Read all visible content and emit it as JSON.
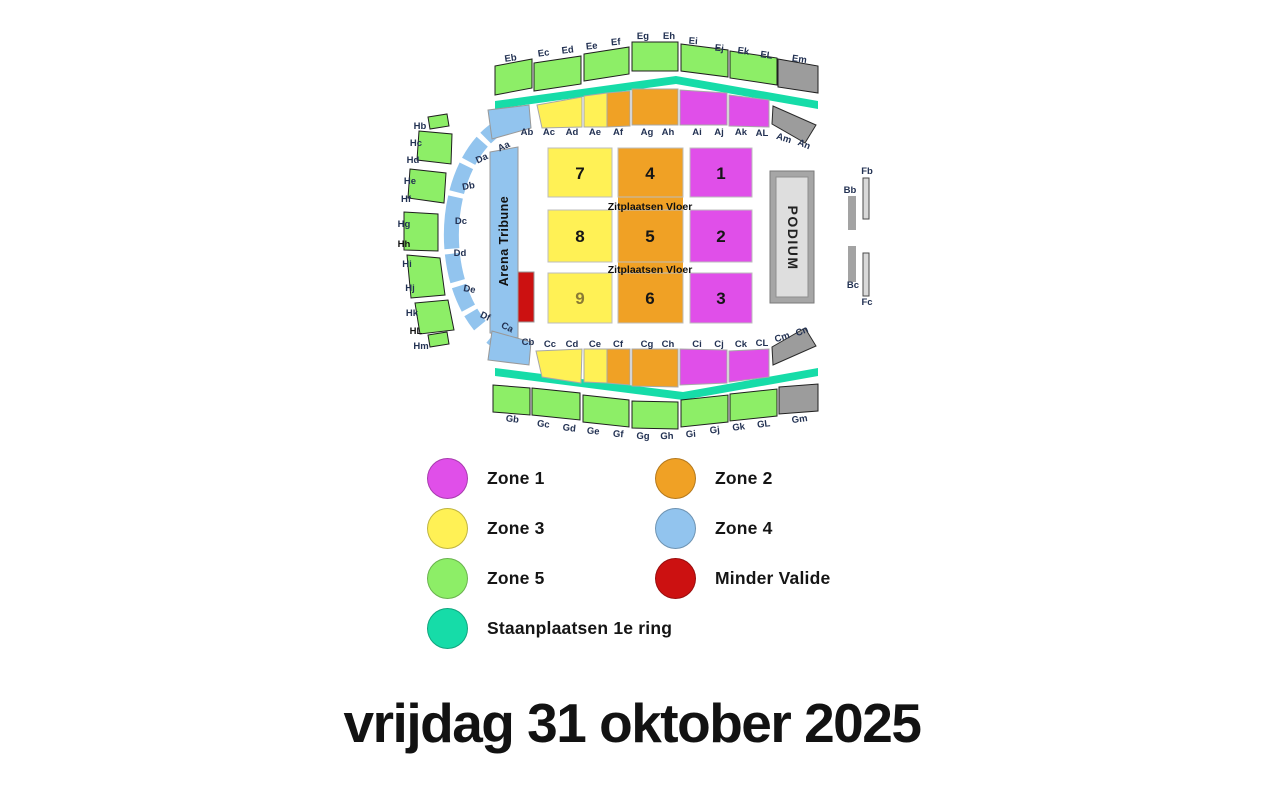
{
  "zones": {
    "zone1": "#E04FE9",
    "zone2": "#F0A125",
    "zone3": "#FFF155",
    "zone4": "#92C4EE",
    "zone5": "#8DEE67",
    "minder_valide": "#CC1111",
    "staanplaatsen": "#16DCA8",
    "gray": "#9C9C9C"
  },
  "map": {
    "label_color": "#233253",
    "shapes": [
      {
        "t": "poly",
        "n": "standing-ring-top",
        "z": "staanplaatsen",
        "i": true,
        "pts": "495,101 676,76 818,101 818,109 676,84 495,109"
      },
      {
        "t": "poly",
        "n": "standing-ring-bottom",
        "z": "staanplaatsen",
        "i": true,
        "pts": "495,368 683,392 818,368 818,376 683,400 495,376"
      },
      {
        "t": "path",
        "n": "ring-sections-arc",
        "z": "zone4",
        "i": true,
        "d": "M 498 128 A 76 116 0 0 0 498 342",
        "sw": 15,
        "da": "16 5 24 5 28 5 52 5 28 5 24 5 16"
      },
      {
        "t": "poly",
        "n": "section-arena-tribune",
        "z": "zone4",
        "st": "#999999",
        "i": true,
        "pts": "490,152 518,147 518,338 490,333"
      },
      {
        "t": "poly",
        "n": "section-ab",
        "z": "zone4",
        "st": "#999999",
        "i": true,
        "pts": "488,110 529,105 531,128 492,139"
      },
      {
        "t": "poly",
        "n": "section-cb",
        "z": "zone4",
        "st": "#999999",
        "i": true,
        "pts": "492,331 531,342 529,365 488,360"
      },
      {
        "t": "poly",
        "n": "section-eb",
        "z": "zone5",
        "st": "#1F1F1F",
        "i": true,
        "pts": "495,66 532,59 532,88 495,95"
      },
      {
        "t": "poly",
        "n": "section-ec-ed",
        "z": "zone5",
        "st": "#1F1F1F",
        "i": true,
        "pts": "534,63 581,56 581,84 534,91"
      },
      {
        "t": "poly",
        "n": "section-ee-ef",
        "z": "zone5",
        "st": "#1F1F1F",
        "i": true,
        "pts": "584,54 629,47 629,74 584,81"
      },
      {
        "t": "poly",
        "n": "section-eg-eh",
        "z": "zone5",
        "st": "#1F1F1F",
        "i": true,
        "pts": "632,42 678,42 678,71 632,71"
      },
      {
        "t": "poly",
        "n": "section-ei-ej",
        "z": "zone5",
        "st": "#1F1F1F",
        "i": true,
        "pts": "681,44 728,50 728,77 681,71"
      },
      {
        "t": "poly",
        "n": "section-ek-el",
        "z": "zone5",
        "st": "#1F1F1F",
        "i": true,
        "pts": "730,51 777,58 777,85 730,78"
      },
      {
        "t": "poly",
        "n": "section-em",
        "z": "gray",
        "st": "#1F1F1F",
        "i": true,
        "pts": "778,59 818,66 818,93 778,87"
      },
      {
        "t": "poly",
        "n": "section-gb",
        "z": "zone5",
        "st": "#1F1F1F",
        "i": true,
        "pts": "493,385 530,388 530,415 493,412"
      },
      {
        "t": "poly",
        "n": "section-gc-gd",
        "z": "zone5",
        "st": "#1F1F1F",
        "i": true,
        "pts": "532,388 580,393 580,420 532,415"
      },
      {
        "t": "poly",
        "n": "section-ge-gf",
        "z": "zone5",
        "st": "#1F1F1F",
        "i": true,
        "pts": "583,395 629,400 629,427 583,422"
      },
      {
        "t": "poly",
        "n": "section-gg-gh",
        "z": "zone5",
        "st": "#1F1F1F",
        "i": true,
        "pts": "632,401 678,402 678,429 632,428"
      },
      {
        "t": "poly",
        "n": "section-gi-gj",
        "z": "zone5",
        "st": "#1F1F1F",
        "i": true,
        "pts": "681,400 728,395 728,422 681,427"
      },
      {
        "t": "poly",
        "n": "section-gk-gl",
        "z": "zone5",
        "st": "#1F1F1F",
        "i": true,
        "pts": "730,394 777,389 777,416 730,421"
      },
      {
        "t": "poly",
        "n": "section-gm",
        "z": "gray",
        "st": "#1F1F1F",
        "i": true,
        "pts": "779,387 818,384 818,411 779,414"
      },
      {
        "t": "poly",
        "n": "section-ac-ad",
        "z": "zone3",
        "st": "#A8A8A8",
        "i": true,
        "pts": "537,105 582,97 582,127 542,128"
      },
      {
        "t": "poly",
        "n": "section-ae",
        "z": "zone3",
        "st": "#A8A8A8",
        "i": true,
        "pts": "584,96 607,93 607,127 584,127"
      },
      {
        "t": "poly",
        "n": "section-af",
        "z": "zone2",
        "st": "#A8A8A8",
        "i": true,
        "pts": "607,93 630,91 630,126 607,127"
      },
      {
        "t": "poly",
        "n": "section-ag-ah",
        "z": "zone2",
        "st": "#A8A8A8",
        "i": true,
        "pts": "632,89 678,89 678,125 632,125"
      },
      {
        "t": "poly",
        "n": "section-ai-aj",
        "z": "zone1",
        "st": "#A8A8A8",
        "i": true,
        "pts": "680,90 727,93 727,125 680,125"
      },
      {
        "t": "poly",
        "n": "section-ak-al",
        "z": "zone1",
        "st": "#A8A8A8",
        "i": true,
        "pts": "729,95 769,100 769,127 729,126"
      },
      {
        "t": "poly",
        "n": "section-am-an",
        "z": "gray",
        "st": "#2A2A2A",
        "i": true,
        "pts": "773,106 816,125 805,143 772,124"
      },
      {
        "t": "poly",
        "n": "section-cc-cd",
        "z": "zone3",
        "st": "#A8A8A8",
        "i": true,
        "pts": "536,351 582,349 581,383 542,377"
      },
      {
        "t": "poly",
        "n": "section-ce",
        "z": "zone3",
        "st": "#A8A8A8",
        "i": true,
        "pts": "584,349 607,349 607,383 584,382"
      },
      {
        "t": "poly",
        "n": "section-cf",
        "z": "zone2",
        "st": "#A8A8A8",
        "i": true,
        "pts": "607,349 630,349 630,385 607,383"
      },
      {
        "t": "poly",
        "n": "section-cg-ch",
        "z": "zone2",
        "st": "#A8A8A8",
        "i": true,
        "pts": "632,349 678,349 678,387 632,386"
      },
      {
        "t": "poly",
        "n": "section-ci-cj",
        "z": "zone1",
        "st": "#A8A8A8",
        "i": true,
        "pts": "680,349 727,350 727,383 680,385"
      },
      {
        "t": "poly",
        "n": "section-ck-cl",
        "z": "zone1",
        "st": "#A8A8A8",
        "i": true,
        "pts": "729,351 769,349 769,377 729,382"
      },
      {
        "t": "poly",
        "n": "section-cm-cn",
        "z": "gray",
        "st": "#2A2A2A",
        "i": true,
        "pts": "773,365 816,346 805,328 772,347"
      },
      {
        "t": "poly",
        "n": "section-hb",
        "z": "zone5",
        "st": "#1F1F1F",
        "i": true,
        "pts": "428,117 447,114 449,126 430,129"
      },
      {
        "t": "poly",
        "n": "section-hc-hd",
        "z": "zone5",
        "st": "#1F1F1F",
        "i": true,
        "pts": "419,131 452,134 451,164 417,160"
      },
      {
        "t": "poly",
        "n": "section-he-hf",
        "z": "zone5",
        "st": "#1F1F1F",
        "i": true,
        "pts": "410,169 446,173 444,203 408,198"
      },
      {
        "t": "poly",
        "n": "section-hg-hh",
        "z": "zone5",
        "st": "#1F1F1F",
        "i": true,
        "pts": "404,212 438,214 438,251 404,250"
      },
      {
        "t": "poly",
        "n": "section-hi-hj",
        "z": "zone5",
        "st": "#1F1F1F",
        "i": true,
        "pts": "407,255 440,258 445,295 411,298"
      },
      {
        "t": "poly",
        "n": "section-hk-hl",
        "z": "zone5",
        "st": "#1F1F1F",
        "i": true,
        "pts": "415,303 448,300 454,330 420,334"
      },
      {
        "t": "poly",
        "n": "section-hm",
        "z": "zone5",
        "st": "#1F1F1F",
        "i": true,
        "pts": "428,335 447,332 449,344 430,347"
      },
      {
        "t": "rect",
        "n": "section-minder-valide",
        "z": "minder_valide",
        "st": "#999999",
        "i": true,
        "x": 518,
        "y": 272,
        "w": 16,
        "h": 50
      },
      {
        "t": "rect",
        "n": "floor-orange-strip",
        "z": "zone2",
        "i": false,
        "x": 618,
        "y": 148,
        "w": 65,
        "h": 175
      },
      {
        "t": "rect",
        "n": "floor-block-7",
        "z": "zone3",
        "st": "#BDBDBD",
        "i": true,
        "x": 548,
        "y": 148,
        "w": 64,
        "h": 49
      },
      {
        "t": "rect",
        "n": "floor-block-8",
        "z": "zone3",
        "st": "#BDBDBD",
        "i": true,
        "x": 548,
        "y": 210,
        "w": 64,
        "h": 52
      },
      {
        "t": "rect",
        "n": "floor-block-9",
        "z": "zone3",
        "st": "#BDBDBD",
        "i": true,
        "x": 548,
        "y": 273,
        "w": 64,
        "h": 50
      },
      {
        "t": "rect",
        "n": "floor-block-4",
        "z": "zone2",
        "st": "#BDBDBD",
        "i": true,
        "x": 618,
        "y": 148,
        "w": 65,
        "h": 49
      },
      {
        "t": "rect",
        "n": "floor-block-5",
        "z": "zone2",
        "st": "#BDBDBD",
        "i": true,
        "x": 618,
        "y": 210,
        "w": 65,
        "h": 52
      },
      {
        "t": "rect",
        "n": "floor-block-6",
        "z": "zone2",
        "st": "#BDBDBD",
        "i": true,
        "x": 618,
        "y": 273,
        "w": 65,
        "h": 50
      },
      {
        "t": "rect",
        "n": "floor-block-1",
        "z": "zone1",
        "st": "#BDBDBD",
        "i": true,
        "x": 690,
        "y": 148,
        "w": 62,
        "h": 49
      },
      {
        "t": "rect",
        "n": "floor-block-2",
        "z": "zone1",
        "st": "#BDBDBD",
        "i": true,
        "x": 690,
        "y": 210,
        "w": 62,
        "h": 52
      },
      {
        "t": "rect",
        "n": "floor-block-3",
        "z": "zone1",
        "st": "#BDBDBD",
        "i": true,
        "x": 690,
        "y": 273,
        "w": 62,
        "h": 50
      },
      {
        "t": "rect",
        "n": "podium-frame",
        "f": "#A6A6A6",
        "st": "#7A7A7A",
        "i": false,
        "x": 770,
        "y": 171,
        "w": 44,
        "h": 132
      },
      {
        "t": "rect",
        "n": "podium-stage",
        "f": "#DEDEDE",
        "st": "#8F8F8F",
        "i": false,
        "x": 776,
        "y": 177,
        "w": 32,
        "h": 120
      },
      {
        "t": "rect",
        "n": "section-bb",
        "f": "#A3A3A3",
        "i": true,
        "x": 848,
        "y": 196,
        "w": 8,
        "h": 34
      },
      {
        "t": "rect",
        "n": "section-bc",
        "f": "#A3A3A3",
        "i": true,
        "x": 848,
        "y": 246,
        "w": 8,
        "h": 36
      },
      {
        "t": "rect",
        "n": "section-fb",
        "f": "#D9D9D9",
        "st": "#4A4A4A",
        "i": true,
        "x": 863,
        "y": 178,
        "w": 6,
        "h": 41
      },
      {
        "t": "rect",
        "n": "section-fc",
        "f": "#D9D9D9",
        "st": "#4A4A4A",
        "i": true,
        "x": 863,
        "y": 253,
        "w": 6,
        "h": 43
      }
    ],
    "texts": [
      {
        "s": "Eb",
        "x": 511,
        "y": 61,
        "r": -8
      },
      {
        "s": "Ec",
        "x": 544,
        "y": 56,
        "r": -8
      },
      {
        "s": "Ed",
        "x": 568,
        "y": 53,
        "r": -7
      },
      {
        "s": "Ee",
        "x": 592,
        "y": 49,
        "r": -6
      },
      {
        "s": "Ef",
        "x": 616,
        "y": 45,
        "r": -5
      },
      {
        "s": "Eg",
        "x": 643,
        "y": 39,
        "r": -1
      },
      {
        "s": "Eh",
        "x": 669,
        "y": 39,
        "r": 1
      },
      {
        "s": "Ei",
        "x": 693,
        "y": 44,
        "r": 4
      },
      {
        "s": "Ej",
        "x": 719,
        "y": 51,
        "r": 6
      },
      {
        "s": "Ek",
        "x": 743,
        "y": 54,
        "r": 7
      },
      {
        "s": "EL",
        "x": 766,
        "y": 58,
        "r": 8
      },
      {
        "s": "Em",
        "x": 799,
        "y": 62,
        "r": 8
      },
      {
        "s": "Ab",
        "x": 527,
        "y": 135
      },
      {
        "s": "Ac",
        "x": 549,
        "y": 135
      },
      {
        "s": "Ad",
        "x": 572,
        "y": 135
      },
      {
        "s": "Ae",
        "x": 595,
        "y": 135
      },
      {
        "s": "Af",
        "x": 618,
        "y": 135
      },
      {
        "s": "Ag",
        "x": 647,
        "y": 135
      },
      {
        "s": "Ah",
        "x": 668,
        "y": 135
      },
      {
        "s": "Ai",
        "x": 697,
        "y": 135
      },
      {
        "s": "Aj",
        "x": 719,
        "y": 135
      },
      {
        "s": "Ak",
        "x": 741,
        "y": 135
      },
      {
        "s": "AL",
        "x": 762,
        "y": 136
      },
      {
        "s": "Am",
        "x": 783,
        "y": 141,
        "r": 18
      },
      {
        "s": "An",
        "x": 803,
        "y": 147,
        "r": 22
      },
      {
        "s": "Aa",
        "x": 505,
        "y": 149,
        "r": -25
      },
      {
        "s": "Da",
        "x": 483,
        "y": 161,
        "r": -25
      },
      {
        "s": "Db",
        "x": 469,
        "y": 189,
        "r": -10
      },
      {
        "s": "Dc",
        "x": 461,
        "y": 224
      },
      {
        "s": "Dd",
        "x": 460,
        "y": 256
      },
      {
        "s": "De",
        "x": 469,
        "y": 292,
        "r": 10
      },
      {
        "s": "Df",
        "x": 484,
        "y": 319,
        "r": 25
      },
      {
        "s": "Ca",
        "x": 506,
        "y": 330,
        "r": 25
      },
      {
        "s": "Cb",
        "x": 528,
        "y": 345
      },
      {
        "s": "Cc",
        "x": 550,
        "y": 347
      },
      {
        "s": "Cd",
        "x": 572,
        "y": 347
      },
      {
        "s": "Ce",
        "x": 595,
        "y": 347
      },
      {
        "s": "Cf",
        "x": 618,
        "y": 347
      },
      {
        "s": "Cg",
        "x": 647,
        "y": 347
      },
      {
        "s": "Ch",
        "x": 668,
        "y": 347
      },
      {
        "s": "Ci",
        "x": 697,
        "y": 347
      },
      {
        "s": "Cj",
        "x": 719,
        "y": 347
      },
      {
        "s": "Ck",
        "x": 741,
        "y": 347
      },
      {
        "s": "CL",
        "x": 762,
        "y": 346
      },
      {
        "s": "Cm",
        "x": 783,
        "y": 340,
        "r": -18
      },
      {
        "s": "Cn",
        "x": 803,
        "y": 334,
        "r": -22
      },
      {
        "s": "Gb",
        "x": 512,
        "y": 422,
        "r": 7
      },
      {
        "s": "Gc",
        "x": 543,
        "y": 427,
        "r": 7
      },
      {
        "s": "Gd",
        "x": 569,
        "y": 431,
        "r": 6
      },
      {
        "s": "Ge",
        "x": 593,
        "y": 434,
        "r": 5
      },
      {
        "s": "Gf",
        "x": 618,
        "y": 437,
        "r": 4
      },
      {
        "s": "Gg",
        "x": 643,
        "y": 439,
        "r": 1
      },
      {
        "s": "Gh",
        "x": 667,
        "y": 439,
        "r": -1
      },
      {
        "s": "Gi",
        "x": 691,
        "y": 437,
        "r": -4
      },
      {
        "s": "Gj",
        "x": 715,
        "y": 433,
        "r": -6
      },
      {
        "s": "Gk",
        "x": 739,
        "y": 430,
        "r": -7
      },
      {
        "s": "GL",
        "x": 764,
        "y": 427,
        "r": -7
      },
      {
        "s": "Gm",
        "x": 800,
        "y": 422,
        "r": -8
      },
      {
        "s": "Hb",
        "x": 420,
        "y": 129
      },
      {
        "s": "Hc",
        "x": 416,
        "y": 146
      },
      {
        "s": "Hd",
        "x": 413,
        "y": 163
      },
      {
        "s": "He",
        "x": 410,
        "y": 184
      },
      {
        "s": "Hf",
        "x": 406,
        "y": 202
      },
      {
        "s": "Hg",
        "x": 404,
        "y": 227
      },
      {
        "s": "Hh",
        "x": 404,
        "y": 247,
        "c": "#111111"
      },
      {
        "s": "Hi",
        "x": 407,
        "y": 267
      },
      {
        "s": "Hj",
        "x": 410,
        "y": 291
      },
      {
        "s": "Hk",
        "x": 412,
        "y": 316
      },
      {
        "s": "HL",
        "x": 416,
        "y": 334,
        "c": "#111111"
      },
      {
        "s": "Hm",
        "x": 421,
        "y": 349
      },
      {
        "s": "Fb",
        "x": 867,
        "y": 174
      },
      {
        "s": "Bb",
        "x": 850,
        "y": 193
      },
      {
        "s": "Bc",
        "x": 853,
        "y": 288
      },
      {
        "s": "Fc",
        "x": 867,
        "y": 305
      },
      {
        "s": "7",
        "x": 580,
        "y": 179,
        "fs": 17,
        "c": "#161616",
        "n": "floor-block-7-label"
      },
      {
        "s": "4",
        "x": 650,
        "y": 179,
        "fs": 17,
        "c": "#161616",
        "n": "floor-block-4-label"
      },
      {
        "s": "1",
        "x": 721,
        "y": 179,
        "fs": 17,
        "c": "#161616",
        "n": "floor-block-1-label"
      },
      {
        "s": "8",
        "x": 580,
        "y": 242,
        "fs": 17,
        "c": "#161616",
        "n": "floor-block-8-label"
      },
      {
        "s": "5",
        "x": 650,
        "y": 242,
        "fs": 17,
        "c": "#161616",
        "n": "floor-block-5-label"
      },
      {
        "s": "2",
        "x": 721,
        "y": 242,
        "fs": 17,
        "c": "#161616",
        "n": "floor-block-2-label"
      },
      {
        "s": "9",
        "x": 580,
        "y": 304,
        "fs": 17,
        "c": "#8A7B35",
        "n": "floor-block-9-label"
      },
      {
        "s": "6",
        "x": 650,
        "y": 304,
        "fs": 17,
        "c": "#161616",
        "n": "floor-block-6-label"
      },
      {
        "s": "3",
        "x": 721,
        "y": 304,
        "fs": 17,
        "c": "#161616",
        "n": "floor-block-3-label"
      },
      {
        "s": "Zitplaatsen Vloer",
        "x": 650,
        "y": 210,
        "fs": 10.5,
        "c": "#111111",
        "n": "zitplaatsen-vloer-label-1"
      },
      {
        "s": "Zitplaatsen Vloer",
        "x": 650,
        "y": 273,
        "fs": 10.5,
        "c": "#111111",
        "n": "zitplaatsen-vloer-label-2"
      },
      {
        "s": "Arena Tribune",
        "x": 508,
        "y": 241,
        "r": -90,
        "fs": 12.5,
        "c": "#111111",
        "ls": 0.5,
        "n": "arena-tribune-label"
      },
      {
        "s": "PODIUM",
        "x": 788,
        "y": 238,
        "r": 90,
        "fs": 14,
        "c": "#222222",
        "ls": 1.5,
        "n": "podium-label"
      }
    ]
  },
  "legend": {
    "items": [
      {
        "label": "Zone 1",
        "zone": "zone1"
      },
      {
        "label": "Zone 2",
        "zone": "zone2"
      },
      {
        "label": "Zone 3",
        "zone": "zone3"
      },
      {
        "label": "Zone 4",
        "zone": "zone4"
      },
      {
        "label": "Zone 5",
        "zone": "zone5"
      },
      {
        "label": "Minder Valide",
        "zone": "minder_valide"
      },
      {
        "label": "Staanplaatsen 1e ring",
        "zone": "staanplaatsen"
      }
    ]
  },
  "footer": {
    "date": "vrijdag 31 oktober 2025"
  }
}
